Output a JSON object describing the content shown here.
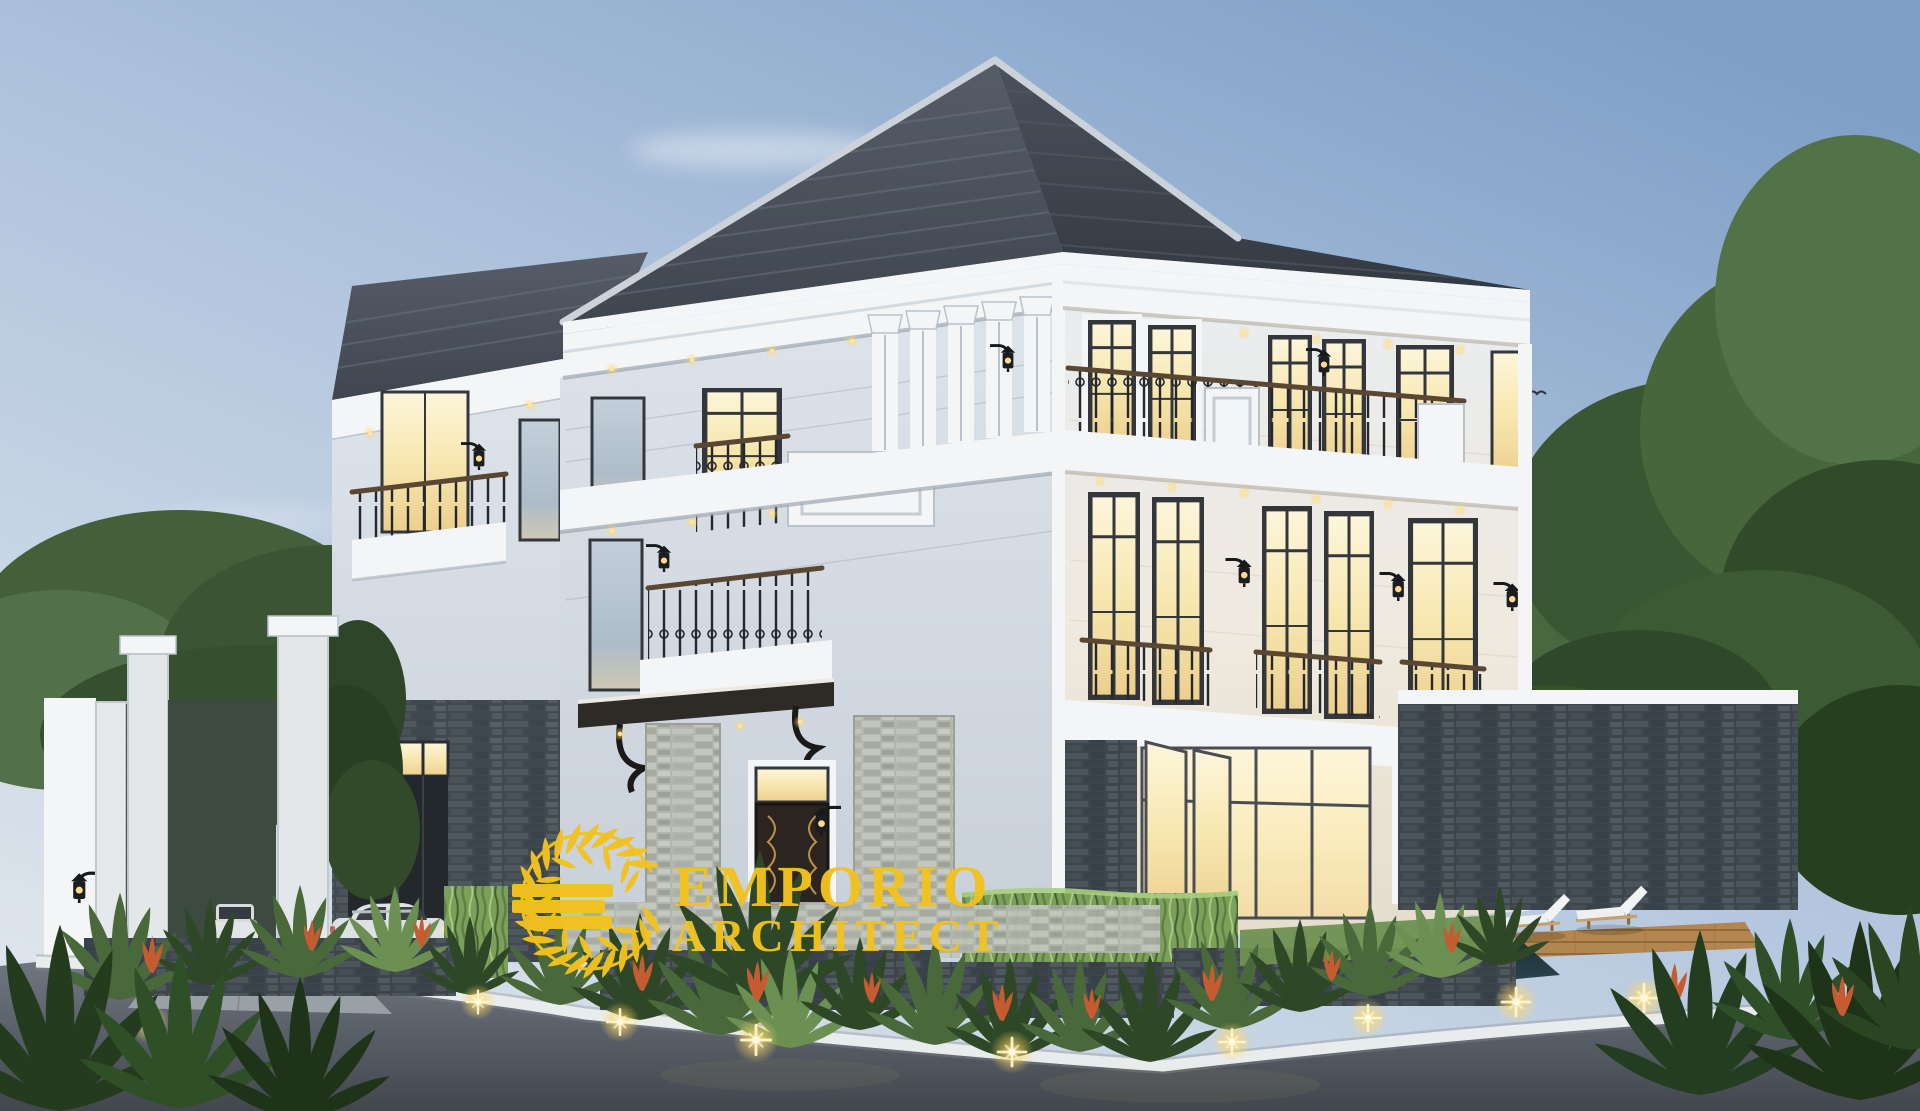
{
  "watermark": {
    "brand_line1": "EMPORIO",
    "brand_line2": "ARCHITECT",
    "logo_icon": "laurel-wreath-e-monogram"
  },
  "scene": {
    "subject": "three-story-classic-luxury-house-exterior-render",
    "time_of_day": "dusk",
    "counts": {
      "sun_loungers": 2,
      "cars": 2,
      "gate_pillars": 2,
      "garden_uplights": 9
    }
  },
  "colors": {
    "logo_gold": "#F2C21E",
    "sky_top": "#7E9FC6",
    "sky_mid": "#AFC3DD",
    "sky_horizon": "#E0E6EC",
    "roof_dark": "#3F4650",
    "roof_mid": "#565D68",
    "cornice_white": "#F3F5F7",
    "facade_warm": "#EFE9DF",
    "facade_cool": "#DDE3EA",
    "window_glow_hi": "#FDF6DC",
    "window_glow_lo": "#ECCF8E",
    "window_cool": "#C3CFDA",
    "foliage_dark": "#2E4727",
    "foliage_mid": "#49693B",
    "foliage_light": "#6C8F52",
    "stone_dark": "#3E464C",
    "stone_light": "#B2B6AD",
    "road_gray": "#6F7680",
    "curb_white": "#E9ECED",
    "light_warm": "#FFD966",
    "accent_flower": "#C65B32",
    "car_body": "#DEE1E4",
    "deck_wood": "#B3854F",
    "pool_water": "#1F3038"
  }
}
